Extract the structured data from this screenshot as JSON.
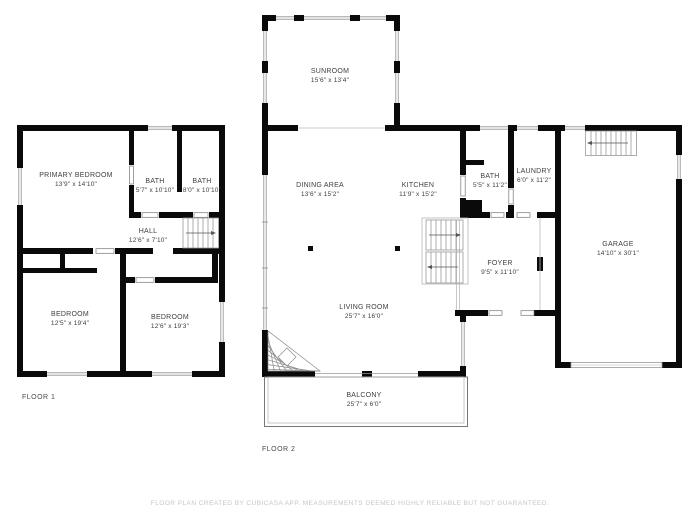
{
  "page": {
    "background": "#ffffff"
  },
  "colors": {
    "wall": "#0a0a0a",
    "window_line": "#8f8f8f",
    "stair_line": "#9a9a9a",
    "label_text": "#3f3f3f",
    "footer_text": "#c6c6c6"
  },
  "floor1": {
    "label": "FLOOR 1",
    "rooms": {
      "primary_bedroom": {
        "name": "PRIMARY BEDROOM",
        "dims": "13'9\" x 14'10\""
      },
      "bath_a": {
        "name": "BATH",
        "dims": "5'7\" x 10'10\""
      },
      "bath_b": {
        "name": "BATH",
        "dims": "8'0\" x 10'10\""
      },
      "hall": {
        "name": "HALL",
        "dims": "12'6\" x 7'10\""
      },
      "bedroom_a": {
        "name": "BEDROOM",
        "dims": "12'5\" x 19'4\""
      },
      "bedroom_b": {
        "name": "BEDROOM",
        "dims": "12'6\" x 19'3\""
      }
    }
  },
  "floor2": {
    "label": "FLOOR 2",
    "rooms": {
      "sunroom": {
        "name": "SUNROOM",
        "dims": "15'6\" x 13'4\""
      },
      "dining_area": {
        "name": "DINING AREA",
        "dims": "13'6\" x 15'2\""
      },
      "kitchen": {
        "name": "KITCHEN",
        "dims": "11'9\" x 15'2\""
      },
      "bath": {
        "name": "BATH",
        "dims": "5'5\" x 11'2\""
      },
      "laundry": {
        "name": "LAUNDRY",
        "dims": "6'0\" x 11'2\""
      },
      "foyer": {
        "name": "FOYER",
        "dims": "9'5\" x 11'10\""
      },
      "garage": {
        "name": "GARAGE",
        "dims": "14'10\" x 30'1\""
      },
      "living_room": {
        "name": "LIVING ROOM",
        "dims": "25'7\" x 16'0\""
      },
      "balcony": {
        "name": "BALCONY",
        "dims": "25'7\" x 6'0\""
      }
    }
  },
  "footer": {
    "disclaimer": "FLOOR PLAN CREATED BY CUBICASA APP. MEASUREMENTS DEEMED HIGHLY RELIABLE BUT NOT GUARANTEED."
  }
}
